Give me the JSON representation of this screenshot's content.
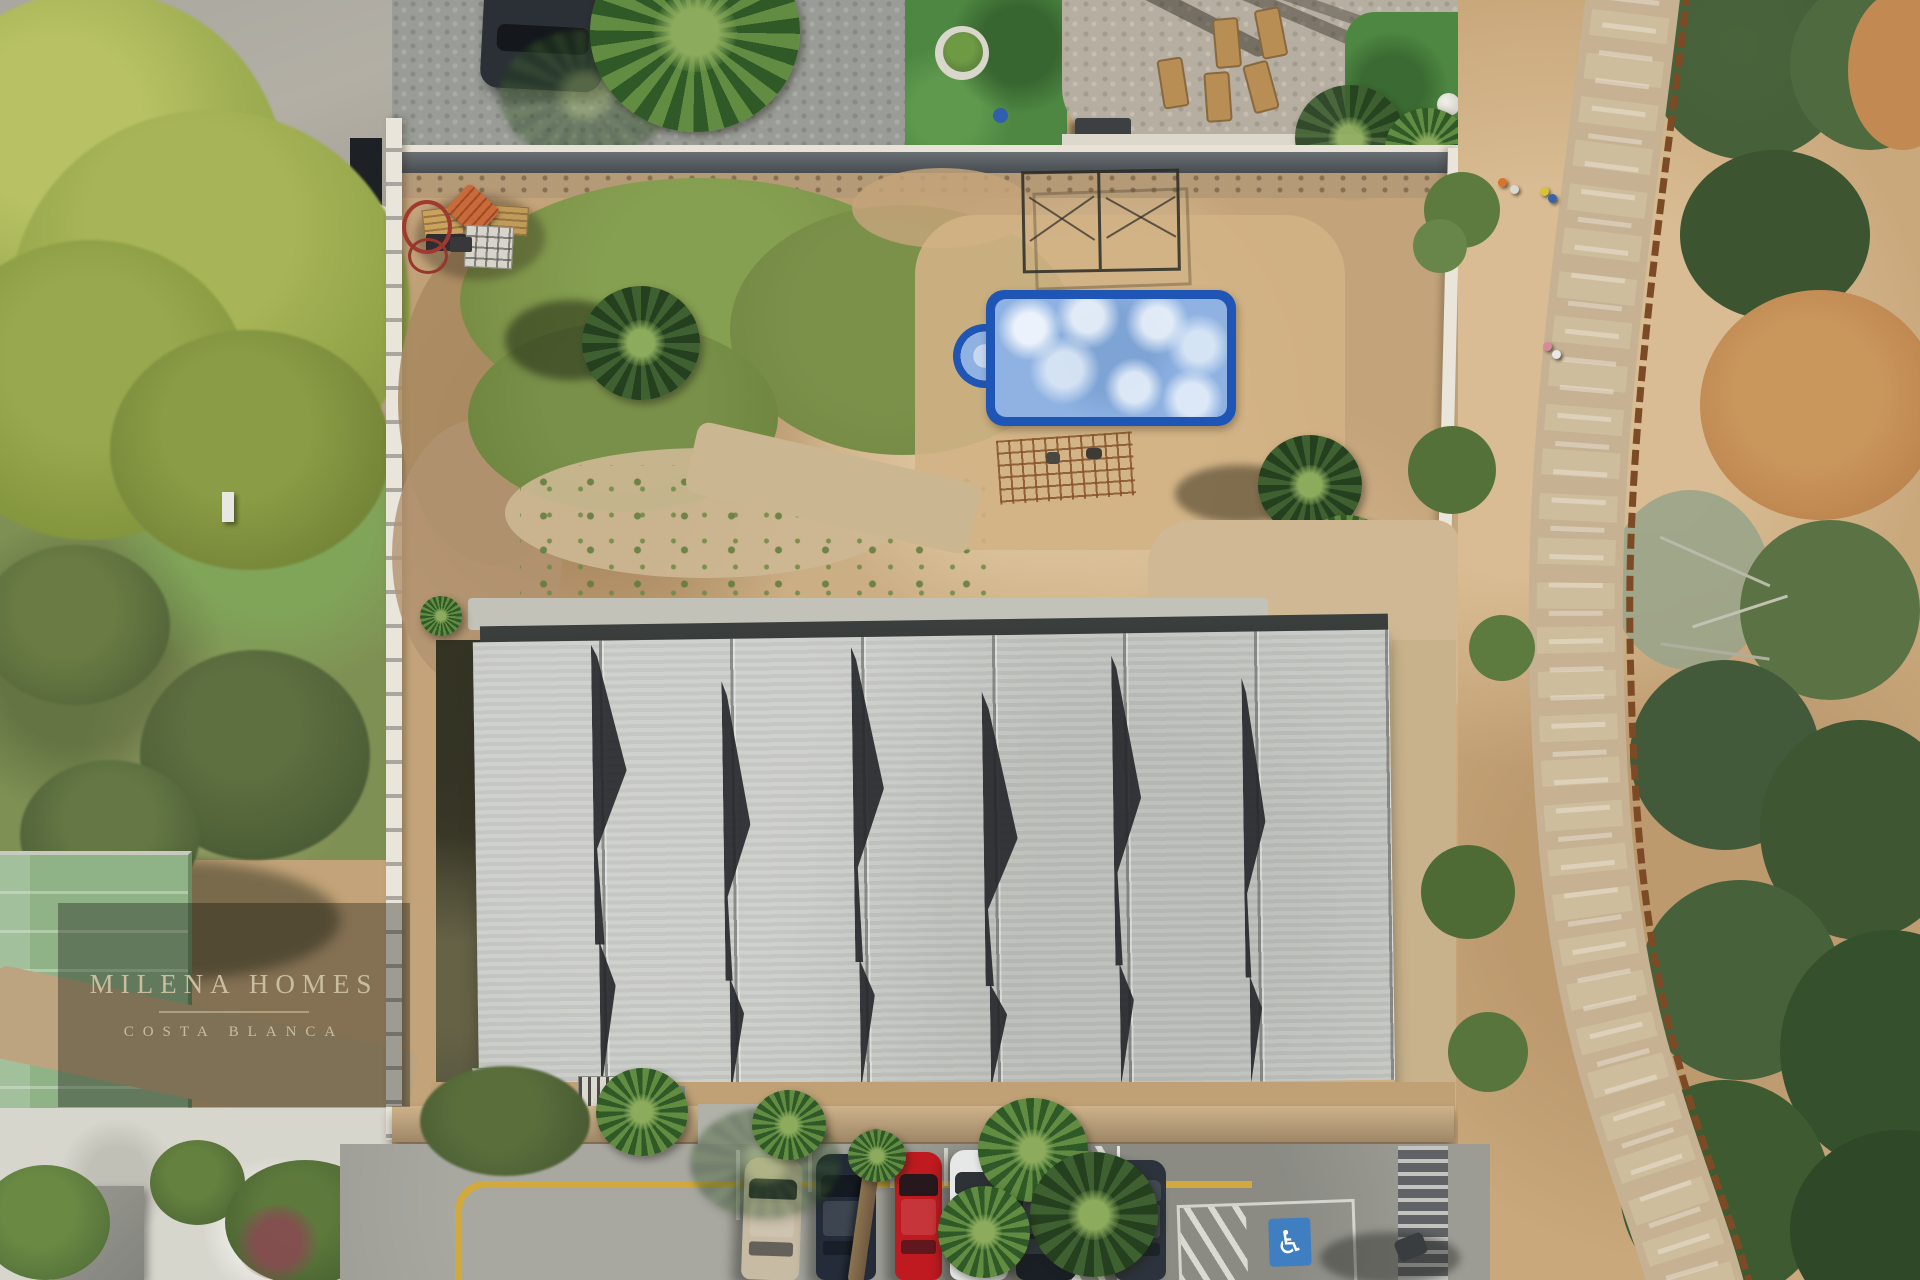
{
  "photo": {
    "kind": "aerial-drone-photograph",
    "subject": "construction plot with concrete sawtooth-roof building, weathered blue pool, dirt garden and street parking, beside a coastal boardwalk"
  },
  "watermark": {
    "line1": "MILENA HOMES",
    "line2": "COSTA BLANCA",
    "text_color": "#c9bda0",
    "panel_color": "rgba(12,14,10,0.34)"
  },
  "palette": {
    "plot_dirt": "#c3a379",
    "grass_patch": "#7d9349",
    "roof_concrete": "#c6c8c4",
    "roof_gap_shadow": "#23262a",
    "road_asphalt": "#9c9c95",
    "curb_line_yellow": "#d1a93c",
    "boardwalk_stone": "#c6b292",
    "railing_rust": "#7c4a24",
    "scrub_green": "#4c6238",
    "turf_green": "#4e8742",
    "court_green": "#8fb286",
    "boundary_wall_white": "#e9e5da"
  },
  "pool": {
    "rim": "#1f55b4",
    "water": "#8fb2e2",
    "feature": "roman-steps"
  },
  "parking": {
    "handicap": {
      "glyph": "♿",
      "square_color": "#3f7fc1"
    },
    "cars": [
      {
        "name": "beige-car",
        "color": "#c7bba4"
      },
      {
        "name": "navy-car",
        "color": "#232c38"
      },
      {
        "name": "red-car",
        "color": "#bf1a1f"
      },
      {
        "name": "white-car",
        "color": "#e6e8e7"
      },
      {
        "name": "black-car",
        "color": "#1a1f26"
      },
      {
        "name": "gray-car",
        "color": "#2c333c"
      }
    ]
  },
  "people_on_path": [
    {
      "name": "walker-orange",
      "color": "#d8742c"
    },
    {
      "name": "walker-white",
      "color": "#d9d9d2"
    },
    {
      "name": "walker-yellow",
      "color": "#d8c23a"
    },
    {
      "name": "walker-blue",
      "color": "#3a62a8"
    },
    {
      "name": "walker-pink",
      "color": "#d88a98"
    },
    {
      "name": "walker-cream",
      "color": "#e8e8e8"
    }
  ]
}
